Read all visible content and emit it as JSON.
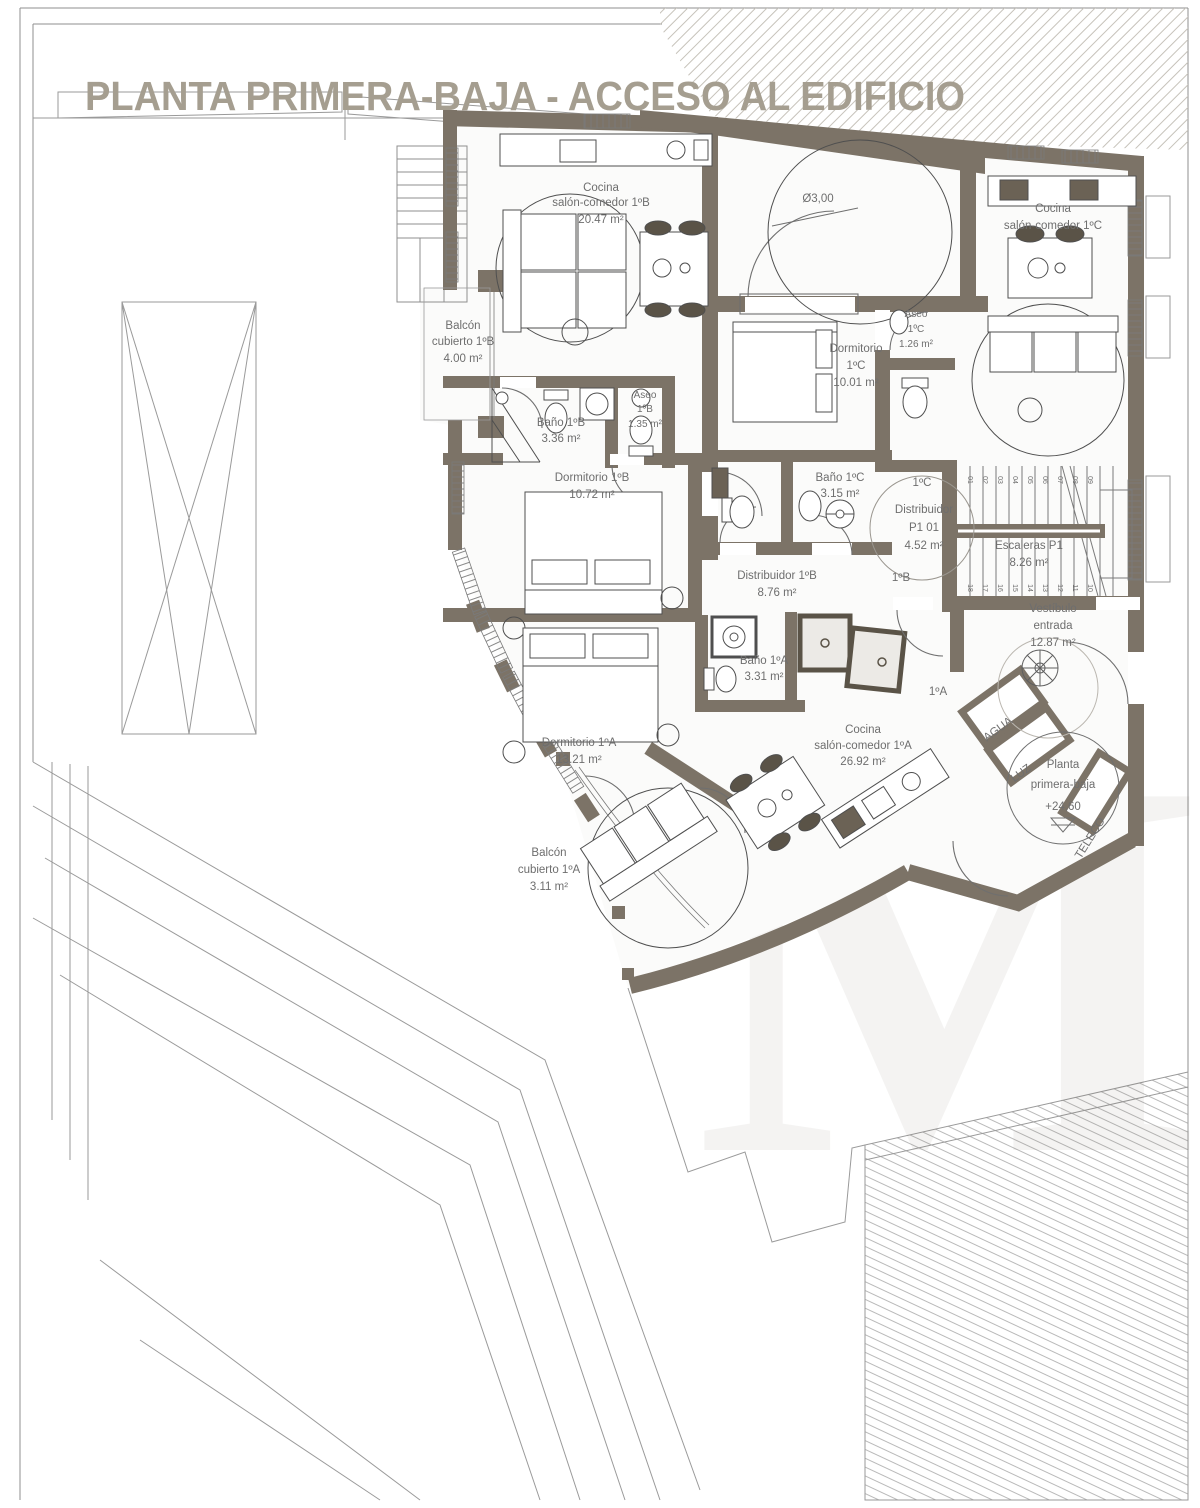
{
  "title": "PLANTA PRIMERA-BAJA - ACCESO AL EDIFICIO",
  "watermark": "M",
  "patio": {
    "diameter_label": "Ø3,00"
  },
  "rooms": [
    {
      "line1": "Cocina",
      "line2": "salón-comedor 1ºB",
      "area": "20.47 m²"
    },
    {
      "line1": "Balcón",
      "line2": "cubierto 1ºB",
      "area": "4.00 m²"
    },
    {
      "line1": "Baño 1ºB",
      "area": "3.36 m²"
    },
    {
      "line1": "Aseo",
      "line2": "1ºB",
      "area": "1.35 m²"
    },
    {
      "line1": "Dormitorio 1ºB",
      "area": "10.72 m²"
    },
    {
      "line1": "Dormitorio",
      "line2": "1ºC",
      "area": "10.01 m²"
    },
    {
      "line1": "Aseo",
      "line2": "1ºC",
      "area": "1.26 m²"
    },
    {
      "line1": "Cocina",
      "line2": "salón-comedor 1ºC"
    },
    {
      "line1": "Baño 1ºC",
      "area": "3.15 m²"
    },
    {
      "line1": "Distribuidor 1ºB",
      "area": "8.76 m²"
    },
    {
      "line1": "Distribuidor",
      "line2": "P1 01",
      "area": "4.52 m²"
    },
    {
      "line1": "Escaleras P1",
      "area": "8.26 m²"
    },
    {
      "line1": "Vestíbulo",
      "line2": "entrada",
      "area": "12.87 m²"
    },
    {
      "line1": "Baño 1ºA",
      "area": "3.31 m²"
    },
    {
      "line1": "Dormitorio 1ºA",
      "area": "13.21 m²"
    },
    {
      "line1": "Cocina",
      "line2": "salón-comedor 1ºA",
      "area": "26.92 m²"
    },
    {
      "line1": "Balcón",
      "line2": "cubierto 1ºA",
      "area": "3.11 m²"
    }
  ],
  "door_labels": [
    "1ºC",
    "1ºB",
    "1ºA"
  ],
  "utilities": [
    "AGUA",
    "LUZ",
    "TELECO"
  ],
  "level_marker": {
    "line1": "Planta",
    "line2": "primera-baja",
    "elevation": "+24,60"
  },
  "stairs": {
    "upper_steps": [
      "01",
      "02",
      "03",
      "04",
      "05",
      "06",
      "07",
      "08",
      "09"
    ],
    "lower_steps": [
      "18",
      "17",
      "16",
      "15",
      "14",
      "13",
      "12",
      "11",
      "10"
    ]
  }
}
